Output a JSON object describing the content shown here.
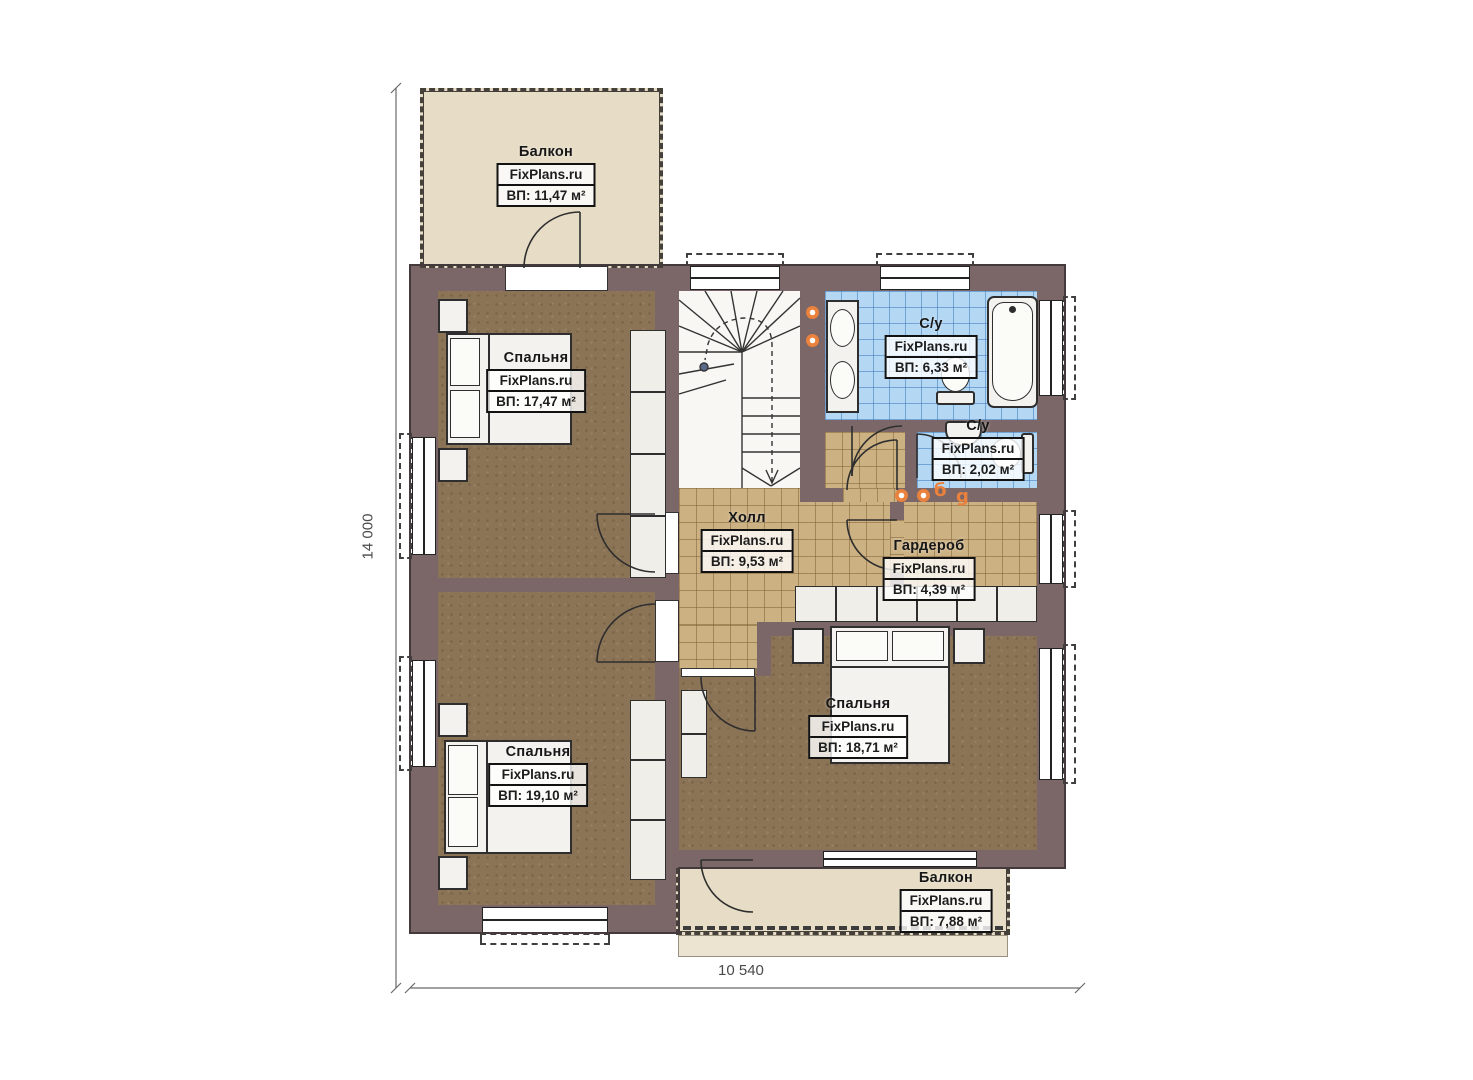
{
  "brand": "FixPlans.ru",
  "dimensions": {
    "left": "14 000",
    "bottom": "10 540"
  },
  "rooms": [
    {
      "id": "balcony-top",
      "name": "Балкон",
      "area": "ВП: 11,47 м²"
    },
    {
      "id": "bedroom-top-left",
      "name": "Спальня",
      "area": "ВП: 17,47 м²"
    },
    {
      "id": "bathroom-main",
      "name": "С/у",
      "area": "ВП: 6,33 м²"
    },
    {
      "id": "bathroom-small",
      "name": "С/у",
      "area": "ВП: 2,02 м²"
    },
    {
      "id": "hall",
      "name": "Холл",
      "area": "ВП: 9,53 м²"
    },
    {
      "id": "wardrobe",
      "name": "Гардероб",
      "area": "ВП: 4,39 м²"
    },
    {
      "id": "bedroom-bottom-left",
      "name": "Спальня",
      "area": "ВП: 19,10 м²"
    },
    {
      "id": "bedroom-right",
      "name": "Спальня",
      "area": "ВП: 18,71 м²"
    },
    {
      "id": "balcony-bottom",
      "name": "Балкон",
      "area": "ВП: 7,88 м²"
    }
  ],
  "markers": {
    "letter_b": "б",
    "letter_g": "g"
  },
  "colors": {
    "wall": "#7b6768",
    "bedroom_floor": "#8b7356",
    "tile_beige": "#ccb183",
    "tile_blue": "#b4d7f3",
    "balcony_floor": "#e7ddc6",
    "accent_orange": "#ea813c"
  }
}
